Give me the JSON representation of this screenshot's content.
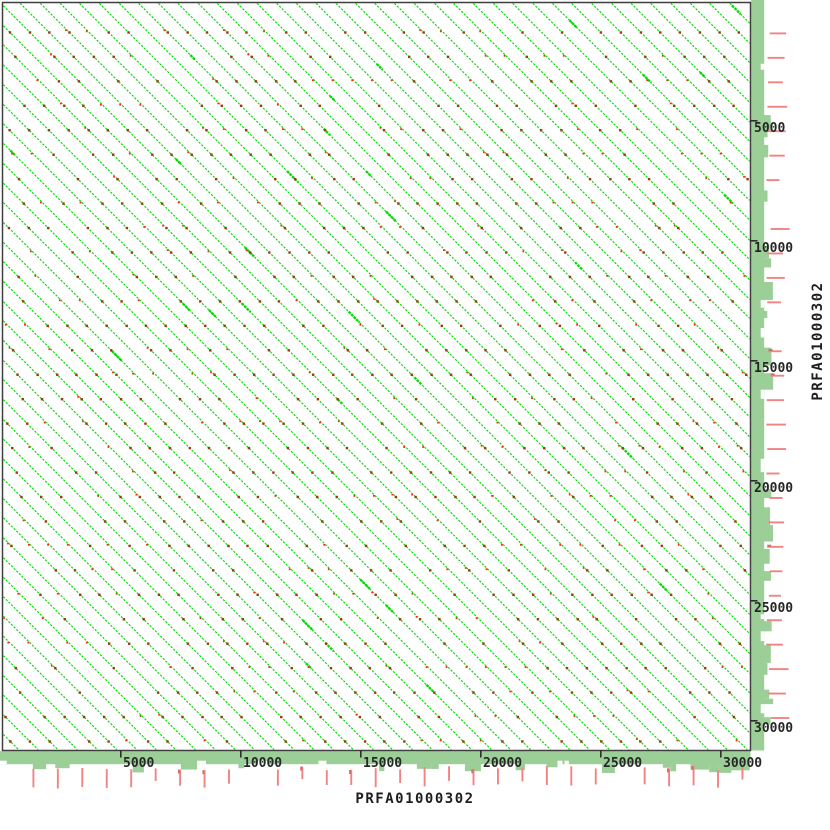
{
  "chart_data": {
    "type": "dotplot",
    "title": "",
    "x_label": "PRFA01000302",
    "y_label": "PRFA01000302",
    "x_sequence": "PRFA01000302",
    "y_sequence": "PRFA01000302",
    "sequence_length_bp": 31250,
    "axis_ticks_bp": [
      5000,
      10000,
      15000,
      20000,
      25000,
      30000
    ],
    "axis_tick_labels": [
      "5000",
      "10000",
      "15000",
      "20000",
      "25000",
      "30000"
    ],
    "minor_tick_interval_bp": 1000,
    "grid": false,
    "legend": null,
    "diagonals": {
      "orientation": "forward",
      "direction": "top-left-to-bottom-right",
      "period_bp": 820,
      "count": 77,
      "description": "Self-alignment dotplot: dense parallel forward diagonals from a tandem repeat covering the whole matrix; small red markers on the diagonals about every 1000 bp"
    },
    "coverage_bands": {
      "position": [
        "right-of-plot",
        "below-plot"
      ],
      "description": "light-green coverage histogram strips with irregular bumps, plus salmon minor tick lines every ~1000 bp"
    }
  },
  "render": {
    "canvas": {
      "width": 830,
      "height": 830
    },
    "plot": {
      "left": 2.5,
      "top": 2.5,
      "right": 750.5,
      "bottom": 750.5
    },
    "px_per_bp": 0.024,
    "line_spacing_px": 19.7,
    "line_intercept_offset_px": -2.5,
    "dot_row_spacing_px": 24.45,
    "dot_row_offset_px": 8.0,
    "band_thickness_px": 13,
    "seed": 42,
    "colors": {
      "background": "#ffffff",
      "plot_border": "#3f3f3f",
      "diagonal_line": "#00dc00",
      "coverage_band": "#9cce98",
      "minor_tick_red": "#f28383",
      "minor_tick_dark": "#d86a6a",
      "major_tick": "#2f2f2f",
      "dot_dark_red": "#993a10",
      "dot_bright_red": "#ff2600",
      "axis_text": "#262626"
    }
  }
}
